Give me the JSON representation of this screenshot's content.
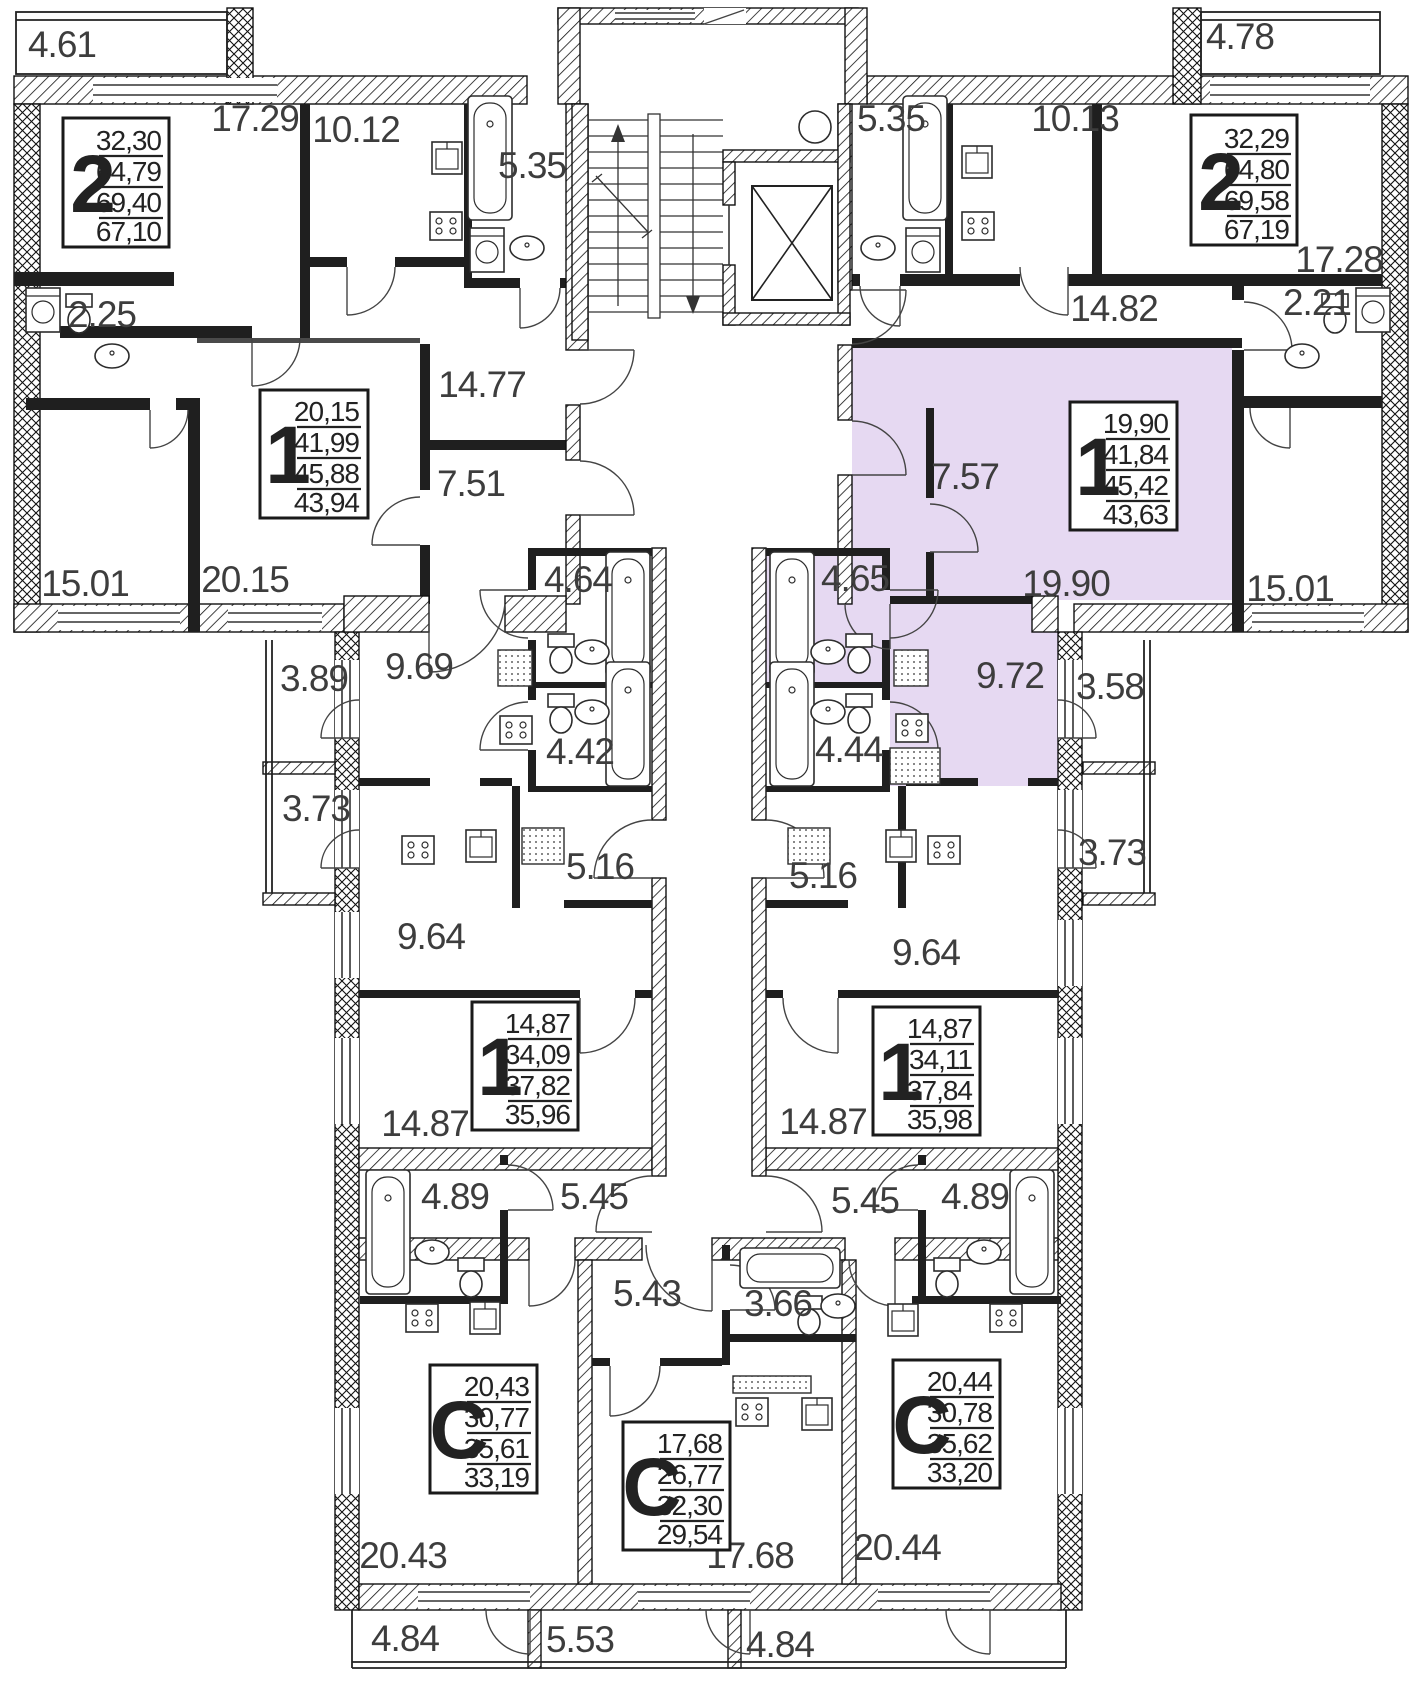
{
  "colors": {
    "highlight": "#e6d9f2",
    "wall": "#1a1a1a",
    "label": "#3d3d3d"
  },
  "apartments": [
    {
      "id": "apt-2-top-left",
      "type": "2",
      "values": [
        "32,30",
        "64,79",
        "69,40",
        "67,10"
      ],
      "highlighted": false
    },
    {
      "id": "apt-2-top-right",
      "type": "2",
      "values": [
        "32,29",
        "64,80",
        "69,58",
        "67,19"
      ],
      "highlighted": false
    },
    {
      "id": "apt-1-left",
      "type": "1",
      "values": [
        "20,15",
        "41,99",
        "45,88",
        "43,94"
      ],
      "highlighted": false
    },
    {
      "id": "apt-1-right",
      "type": "1",
      "values": [
        "19,90",
        "41,84",
        "45,42",
        "43,63"
      ],
      "highlighted": true
    },
    {
      "id": "apt-1-mid-left",
      "type": "1",
      "values": [
        "14,87",
        "34,09",
        "37,82",
        "35,96"
      ],
      "highlighted": false
    },
    {
      "id": "apt-1-mid-right",
      "type": "1",
      "values": [
        "14,87",
        "34,11",
        "37,84",
        "35,98"
      ],
      "highlighted": false
    },
    {
      "id": "apt-studio-left",
      "type": "C",
      "values": [
        "20,43",
        "30,77",
        "35,61",
        "33,19"
      ],
      "highlighted": false
    },
    {
      "id": "apt-studio-mid",
      "type": "C",
      "values": [
        "17,68",
        "26,77",
        "32,30",
        "29,54"
      ],
      "highlighted": false
    },
    {
      "id": "apt-studio-right",
      "type": "C",
      "values": [
        "20,44",
        "30,78",
        "35,62",
        "33,20"
      ],
      "highlighted": false
    }
  ],
  "labels": [
    {
      "name": "balcony-top-left",
      "text": "4.61"
    },
    {
      "name": "room-17-29",
      "text": "17.29"
    },
    {
      "name": "kitchen-10-12",
      "text": "10.12"
    },
    {
      "name": "bath-5-35-left",
      "text": "5.35"
    },
    {
      "name": "bath-5-35-right",
      "text": "5.35"
    },
    {
      "name": "kitchen-10-13",
      "text": "10.13"
    },
    {
      "name": "balcony-top-right",
      "text": "4.78"
    },
    {
      "name": "room-17-28",
      "text": "17.28"
    },
    {
      "name": "wc-2-25",
      "text": "2.25"
    },
    {
      "name": "hall-14-82",
      "text": "14.82"
    },
    {
      "name": "wc-2-21",
      "text": "2.21"
    },
    {
      "name": "hall-14-77",
      "text": "14.77"
    },
    {
      "name": "hall-7-51",
      "text": "7.51"
    },
    {
      "name": "hall-7-57",
      "text": "7.57"
    },
    {
      "name": "room-15-01-left",
      "text": "15.01"
    },
    {
      "name": "room-20-15",
      "text": "20.15"
    },
    {
      "name": "room-19-90",
      "text": "19.90"
    },
    {
      "name": "room-15-01-right",
      "text": "15.01"
    },
    {
      "name": "bath-4-64",
      "text": "4.64"
    },
    {
      "name": "bath-4-65",
      "text": "4.65"
    },
    {
      "name": "balcony-3-89",
      "text": "3.89"
    },
    {
      "name": "kitchen-9-69",
      "text": "9.69"
    },
    {
      "name": "kitchen-9-72",
      "text": "9.72"
    },
    {
      "name": "balcony-3-58",
      "text": "3.58"
    },
    {
      "name": "bath-4-42",
      "text": "4.42"
    },
    {
      "name": "bath-4-44",
      "text": "4.44"
    },
    {
      "name": "balcony-3-73-left",
      "text": "3.73"
    },
    {
      "name": "balcony-3-73-right",
      "text": "3.73"
    },
    {
      "name": "hall-5-16-left",
      "text": "5.16"
    },
    {
      "name": "hall-5-16-right",
      "text": "5.16"
    },
    {
      "name": "kitchen-9-64-left",
      "text": "9.64"
    },
    {
      "name": "kitchen-9-64-right",
      "text": "9.64"
    },
    {
      "name": "room-14-87-left",
      "text": "14.87"
    },
    {
      "name": "room-14-87-right",
      "text": "14.87"
    },
    {
      "name": "bath-4-89-left",
      "text": "4.89"
    },
    {
      "name": "hall-5-45-left",
      "text": "5.45"
    },
    {
      "name": "hall-5-45-right",
      "text": "5.45"
    },
    {
      "name": "bath-4-89-right",
      "text": "4.89"
    },
    {
      "name": "hall-5-43",
      "text": "5.43"
    },
    {
      "name": "bath-3-66",
      "text": "3.66"
    },
    {
      "name": "room-20-43",
      "text": "20.43"
    },
    {
      "name": "room-17-68",
      "text": "17.68"
    },
    {
      "name": "room-20-44",
      "text": "20.44"
    },
    {
      "name": "balcony-4-84-left",
      "text": "4.84"
    },
    {
      "name": "balcony-5-53",
      "text": "5.53"
    },
    {
      "name": "balcony-4-84-right",
      "text": "4.84"
    }
  ]
}
